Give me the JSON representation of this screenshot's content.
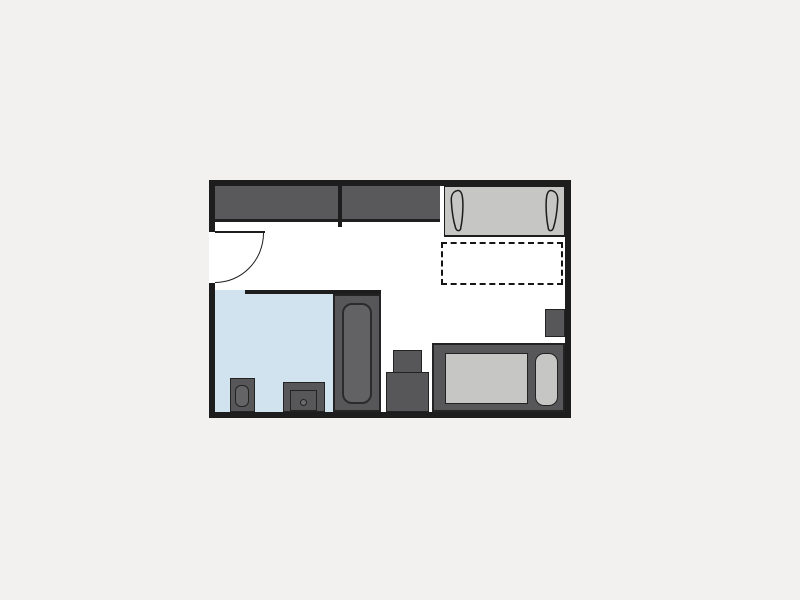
{
  "page": {
    "background": "#f2f1ef",
    "description": "studio-apartment-floor-plan"
  },
  "plan": {
    "colors": {
      "wall": "#1d1d1d",
      "floor": "#ffffff",
      "furniture_dark": "#57575a",
      "furniture_light": "#c6c6c4",
      "bathroom_floor": "#d1e3ef",
      "outline": "#232323"
    },
    "rooms": [
      {
        "name": "main-room",
        "floor_color": "#ffffff"
      },
      {
        "name": "bathroom",
        "floor_color": "#d1e3ef"
      }
    ],
    "furniture": [
      {
        "name": "wardrobe",
        "sections": 2,
        "color": "#59595b"
      },
      {
        "name": "entry-door",
        "type": "swing-door-with-arc"
      },
      {
        "name": "sofa-bed",
        "color": "#c6c6c4",
        "pillows": 2
      },
      {
        "name": "fold-out-bed-area",
        "style": "dashed-outline"
      },
      {
        "name": "bathtub",
        "color": "#57575a"
      },
      {
        "name": "toilet",
        "color": "#57575a"
      },
      {
        "name": "washbasin-cabinet",
        "color": "#57575a"
      },
      {
        "name": "cabinet-stack",
        "color": "#57575a"
      },
      {
        "name": "desk-counter",
        "color": "#57575a"
      },
      {
        "name": "desk-surface",
        "color": "#c6c6c4"
      },
      {
        "name": "seat-pad",
        "color": "#c6c6c4"
      },
      {
        "name": "wall-cabinet",
        "color": "#57575a"
      }
    ]
  }
}
